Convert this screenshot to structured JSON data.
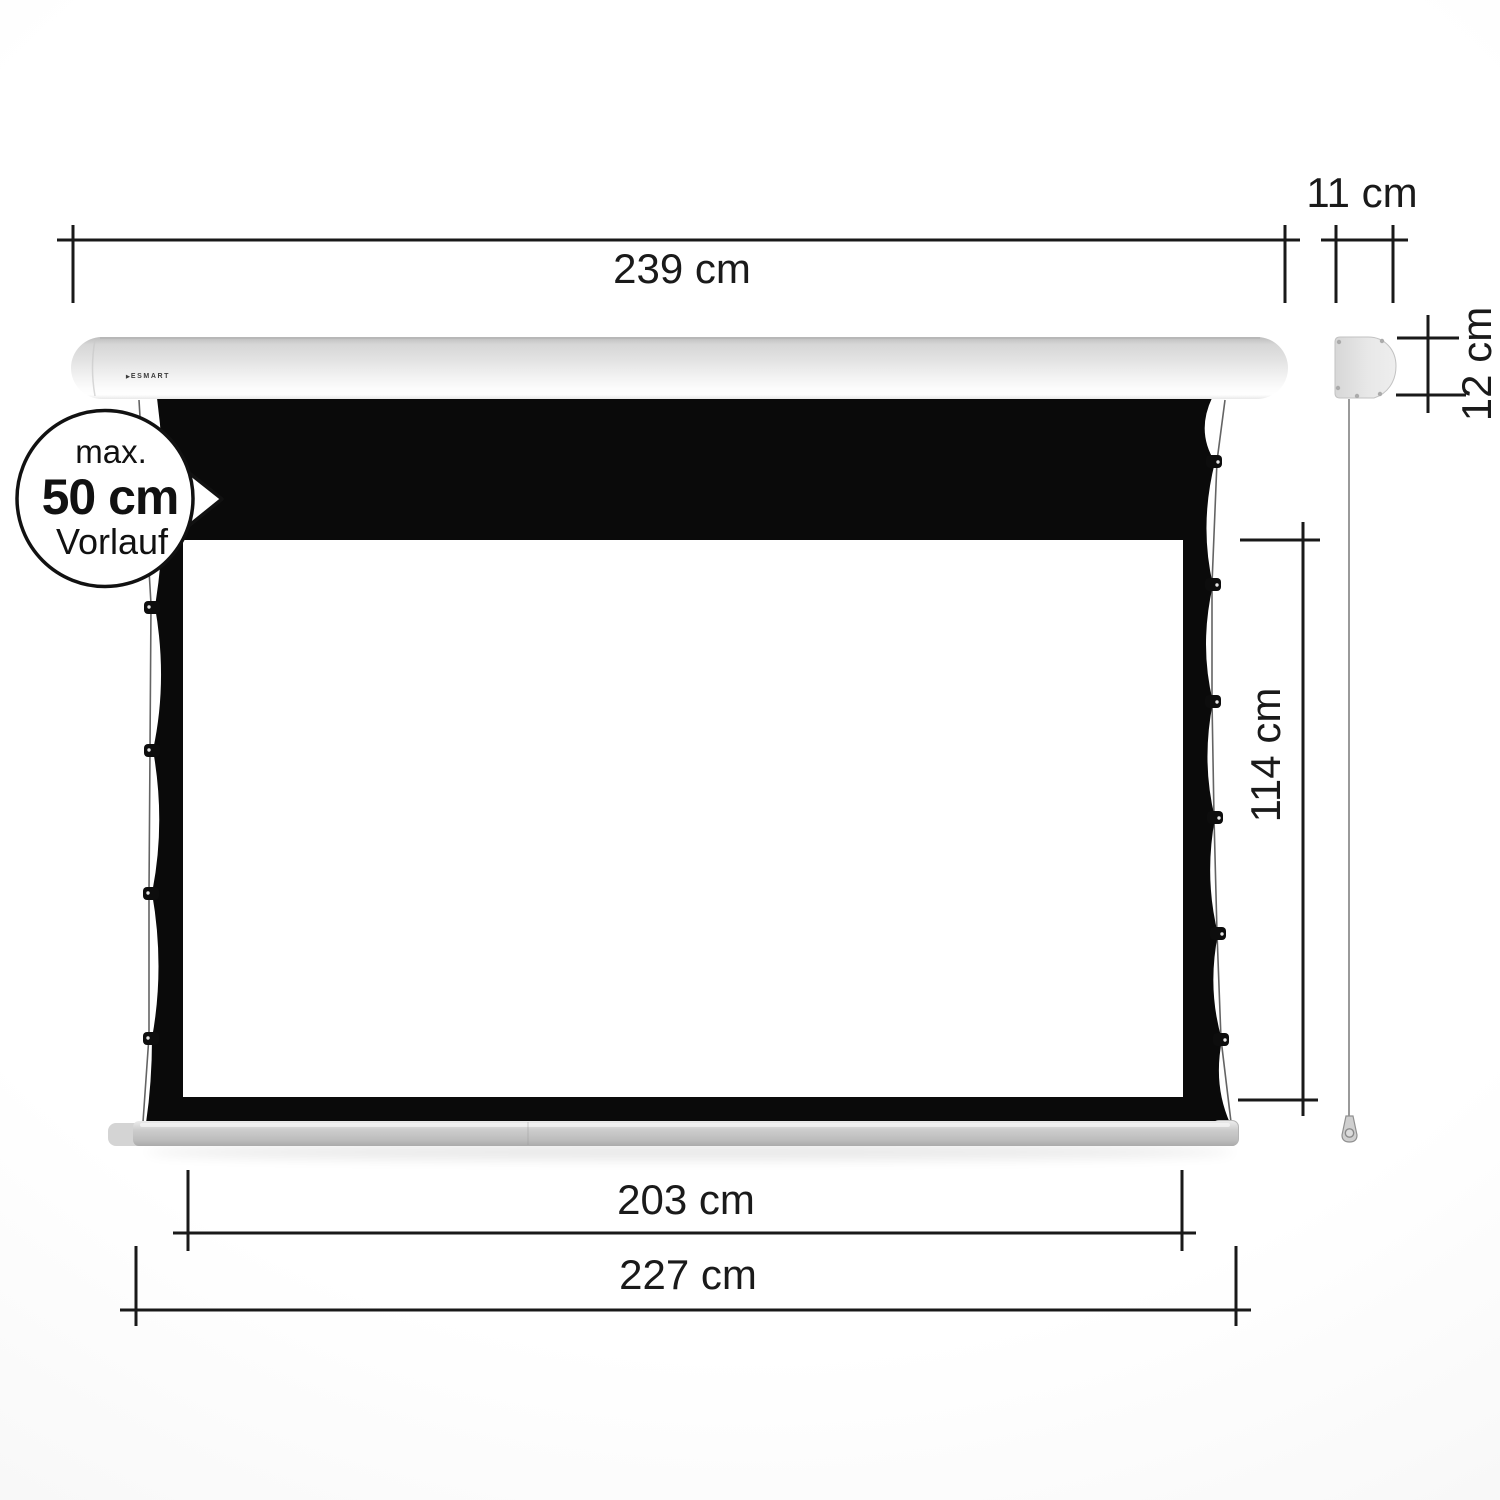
{
  "product": {
    "logo": {
      "arrow": "▶",
      "text": "ESMART"
    }
  },
  "callout": {
    "line1": "max.",
    "line2": "50 cm",
    "line3": "Vorlauf"
  },
  "dimensions": {
    "housing_width": "239 cm",
    "housing_depth": "11 cm",
    "housing_height": "12 cm",
    "viewing_height": "114 cm",
    "viewing_width": "203 cm",
    "bottom_bar_width": "227 cm"
  },
  "colors": {
    "dimension_line": "#191919",
    "fabric_black": "#0a0a0a",
    "housing_light_gray": "#e3e3e3",
    "bar_gray": "#c6c6c6",
    "background": "#f8f8f8",
    "callout_stroke": "#111111"
  }
}
